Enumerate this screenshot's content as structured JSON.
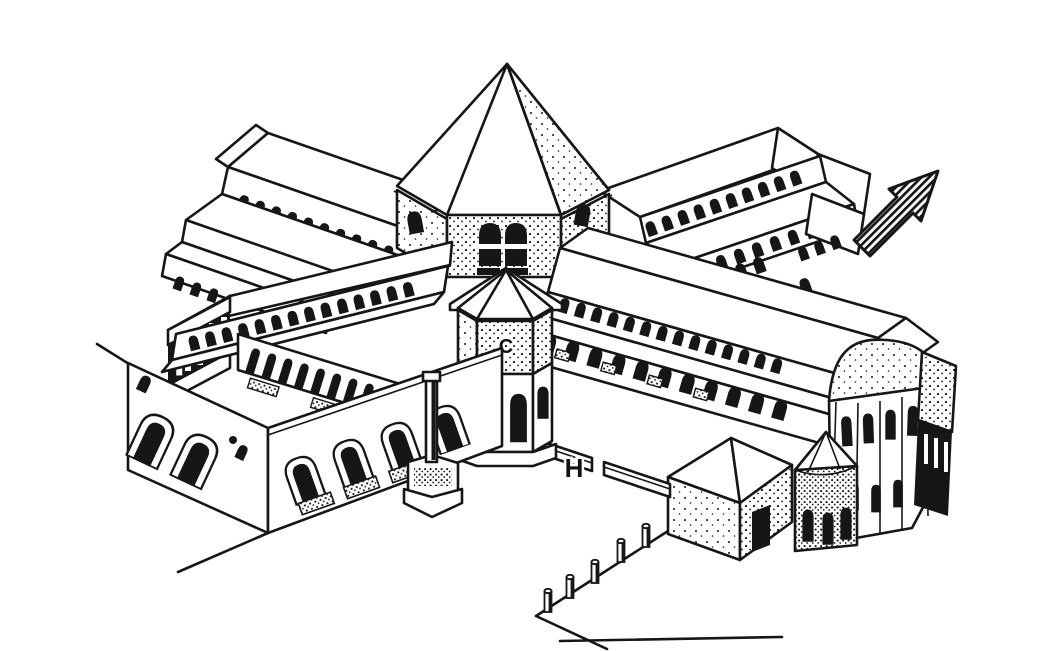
{
  "figure": {
    "type": "isometric architectural line drawing",
    "labels": {
      "c": "C",
      "h": "H"
    }
  },
  "icons": {
    "north_arrow": "northeast-arrow"
  },
  "colors": {
    "ink": "#161616",
    "paper": "#ffffff"
  }
}
